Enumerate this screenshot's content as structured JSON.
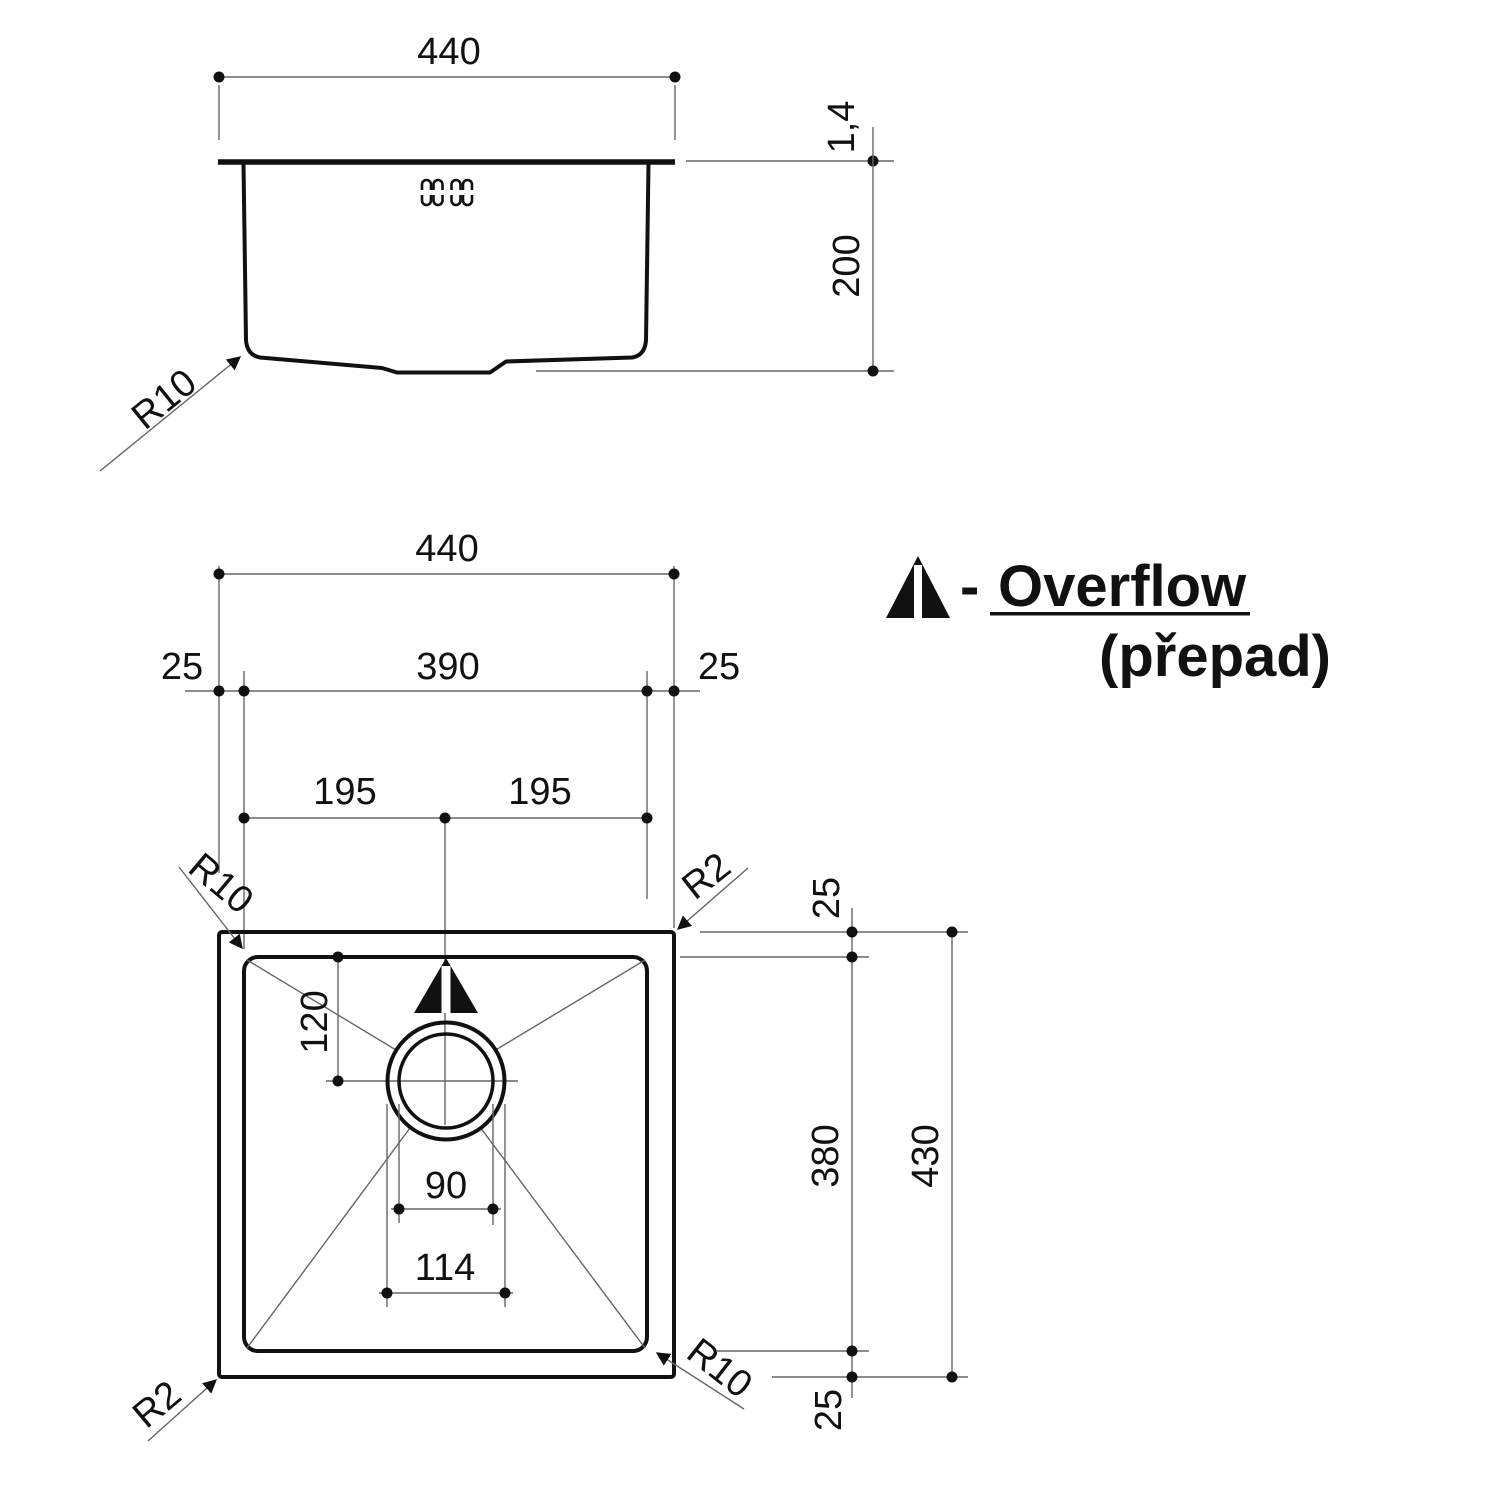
{
  "side_view": {
    "width": "440",
    "rim_thickness": "1,4",
    "depth": "200",
    "bottom_radius": "R10"
  },
  "plan_view": {
    "outer_width": "440",
    "offset_left": "25",
    "inner_width": "390",
    "offset_right": "25",
    "half_left": "195",
    "half_right": "195",
    "corner_inner_top_left": "R10",
    "corner_outer_top_right": "R2",
    "drain_center_from_top": "120",
    "drain_hole_diameter": "90",
    "drain_flange_diameter": "114",
    "corner_outer_bottom_left": "R2",
    "corner_inner_bottom_right": "R10",
    "offset_top": "25",
    "inner_depth": "380",
    "outer_depth": "430",
    "offset_bottom": "25"
  },
  "legend": {
    "separator": "-",
    "term": "Overflow",
    "translation": "(přepad)"
  },
  "colors": {
    "ink": "#111111",
    "dim_line": "#666666"
  }
}
